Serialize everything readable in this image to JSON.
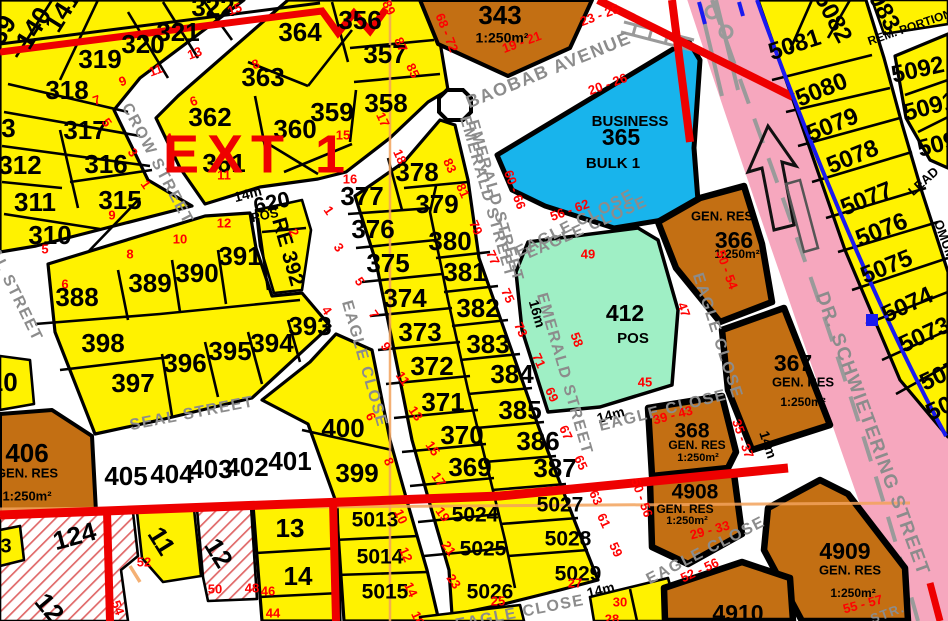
{
  "title": "EXT 1",
  "colors": {
    "yellow": "#FFF200",
    "orange": "#C36F13",
    "cyan": "#18B4EC",
    "green": "#9FEFC5",
    "pink": "#F6A7BE",
    "hatch": "#E06868",
    "redline": "#EE0000",
    "red_text": "#FF0000",
    "blue": "#1A1AEF",
    "street_gray": "#8C8C8C",
    "orangeline": "#F2A25C"
  },
  "labels": {
    "ext": [
      [
        "EXT 1",
        258,
        158
      ]
    ],
    "plots": [
      [
        "313",
        -6,
        130
      ],
      [
        "312",
        20,
        167
      ],
      [
        "311",
        35,
        204
      ],
      [
        "310",
        50,
        237
      ],
      [
        "318",
        67,
        92
      ],
      [
        "319",
        100,
        61
      ],
      [
        "317",
        85,
        132
      ],
      [
        "316",
        106,
        166
      ],
      [
        "315",
        120,
        202
      ],
      [
        "320",
        143,
        46
      ],
      [
        "321",
        178,
        34
      ],
      [
        "322",
        213,
        9
      ],
      [
        "139",
        0,
        37,
        -58
      ],
      [
        "140",
        35,
        29,
        -58
      ],
      [
        "141",
        64,
        12,
        -58
      ],
      [
        "364",
        300,
        34
      ],
      [
        "363",
        263,
        79
      ],
      [
        "362",
        210,
        119
      ],
      [
        "361",
        224,
        165
      ],
      [
        "360",
        295,
        131
      ],
      [
        "356",
        360,
        22
      ],
      [
        "357",
        385,
        56
      ],
      [
        "358",
        386,
        105
      ],
      [
        "359",
        332,
        114
      ],
      [
        "343",
        500,
        17
      ],
      [
        "377",
        362,
        198
      ],
      [
        "378",
        417,
        174
      ],
      [
        "379",
        437,
        206
      ],
      [
        "376",
        373,
        231
      ],
      [
        "375",
        388,
        265
      ],
      [
        "374",
        405,
        300
      ],
      [
        "373",
        420,
        334
      ],
      [
        "372",
        432,
        368
      ],
      [
        "371",
        443,
        404
      ],
      [
        "370",
        462,
        437
      ],
      [
        "369",
        470,
        469
      ],
      [
        "380",
        450,
        243
      ],
      [
        "381",
        465,
        274
      ],
      [
        "382",
        478,
        310
      ],
      [
        "383",
        488,
        346
      ],
      [
        "384",
        512,
        376
      ],
      [
        "385",
        520,
        412
      ],
      [
        "386",
        538,
        443
      ],
      [
        "387",
        555,
        470
      ],
      [
        "388",
        77,
        299
      ],
      [
        "389",
        150,
        285
      ],
      [
        "390",
        197,
        275
      ],
      [
        "391",
        240,
        258
      ],
      [
        "RE 392",
        287,
        252,
        74,
        21
      ],
      [
        "620",
        272,
        204,
        -12,
        22
      ],
      [
        "393",
        310,
        328
      ],
      [
        "394",
        272,
        345
      ],
      [
        "395",
        230,
        353
      ],
      [
        "396",
        185,
        365
      ],
      [
        "397",
        133,
        385
      ],
      [
        "398",
        103,
        345
      ],
      [
        "399",
        357,
        475
      ],
      [
        "400",
        343,
        430
      ],
      [
        "401",
        290,
        463
      ],
      [
        "402",
        247,
        469
      ],
      [
        "403",
        211,
        471
      ],
      [
        "404",
        172,
        476
      ],
      [
        "405",
        126,
        478
      ],
      [
        "406",
        27,
        455
      ],
      [
        "410",
        -4,
        384
      ],
      [
        "124",
        75,
        538,
        -15
      ],
      [
        "11",
        160,
        542,
        58
      ],
      [
        "12",
        217,
        554,
        58
      ],
      [
        "13",
        290,
        530
      ],
      [
        "14",
        298,
        578
      ],
      [
        "12",
        48,
        609,
        50
      ],
      [
        "3",
        6,
        547,
        0,
        20
      ],
      [
        "365",
        621,
        139,
        0,
        23
      ],
      [
        "412",
        625,
        315,
        0,
        23
      ],
      [
        "366",
        734,
        242,
        0,
        23
      ],
      [
        "367",
        793,
        365,
        0,
        23
      ],
      [
        "368",
        692,
        432,
        0,
        21
      ],
      [
        "4908",
        695,
        493,
        0,
        21
      ],
      [
        "4909",
        845,
        553,
        0,
        23
      ],
      [
        "4910",
        738,
        615,
        0,
        23
      ],
      [
        "5013",
        375,
        521,
        0,
        21
      ],
      [
        "5014",
        380,
        558,
        0,
        21
      ],
      [
        "5015",
        385,
        593,
        0,
        21
      ],
      [
        "5024",
        475,
        516,
        0,
        21
      ],
      [
        "5025",
        483,
        550,
        0,
        21
      ],
      [
        "5026",
        490,
        593,
        0,
        21
      ],
      [
        "5027",
        560,
        506,
        0,
        21
      ],
      [
        "5028",
        568,
        540,
        0,
        21
      ],
      [
        "5029",
        578,
        575,
        0,
        21
      ],
      [
        "5081",
        795,
        46,
        -18,
        24
      ],
      [
        "5080",
        822,
        91,
        -22,
        24
      ],
      [
        "5079",
        833,
        126,
        -22,
        24
      ],
      [
        "5078",
        853,
        158,
        -22,
        24
      ],
      [
        "5077",
        867,
        200,
        -22,
        24
      ],
      [
        "5076",
        882,
        231,
        -22,
        24
      ],
      [
        "5075",
        887,
        268,
        -22,
        24
      ],
      [
        "5074",
        908,
        306,
        -25,
        24
      ],
      [
        "5073",
        925,
        336,
        -25,
        24
      ],
      [
        "5072",
        946,
        374,
        -25,
        24
      ],
      [
        "5071",
        952,
        404,
        -25,
        24
      ],
      [
        "5082",
        832,
        18,
        62,
        24
      ],
      [
        "5083",
        880,
        6,
        62,
        24
      ],
      [
        "5092",
        918,
        71,
        -12,
        24
      ],
      [
        "5091",
        930,
        108,
        -15,
        24
      ],
      [
        "5090",
        944,
        144,
        -15,
        24
      ]
    ],
    "areas": [
      [
        "POS",
        265,
        216,
        -12,
        13
      ],
      [
        "POS",
        633,
        339,
        0,
        15
      ],
      [
        "BUSINESS",
        630,
        122,
        0,
        15
      ],
      [
        "BULK 1",
        613,
        164,
        0,
        15
      ],
      [
        "GEN. RES",
        27,
        474,
        0,
        13
      ],
      [
        "1:250m²",
        27,
        497,
        0,
        13
      ],
      [
        "1:250m²",
        502,
        39,
        0,
        14
      ],
      [
        "GEN. RES",
        722,
        217,
        0,
        13
      ],
      [
        "1:250m²",
        737,
        255,
        0,
        12
      ],
      [
        "GEN. RES",
        803,
        383,
        0,
        13
      ],
      [
        "1:250m²",
        803,
        403,
        0,
        12
      ],
      [
        "GEN. RES",
        697,
        446,
        0,
        12
      ],
      [
        "1:250m²",
        698,
        458,
        0,
        11
      ],
      [
        "GEN. RES",
        685,
        510,
        0,
        12
      ],
      [
        "1:250m²",
        687,
        521,
        0,
        11
      ],
      [
        "GEN. RES",
        850,
        571,
        0,
        13
      ],
      [
        "1:250m²",
        853,
        594,
        0,
        12
      ],
      [
        "REM. PORTION",
        910,
        28,
        -19,
        12
      ],
      [
        "LEAD",
        924,
        182,
        -42,
        13
      ],
      [
        "OMUMBONDE",
        952,
        262,
        70,
        13
      ],
      [
        "14m",
        248,
        195,
        -15,
        14
      ],
      [
        "14m",
        611,
        416,
        -16,
        14
      ],
      [
        "14m",
        601,
        591,
        -14,
        14
      ],
      [
        "14m",
        767,
        445,
        72,
        14
      ],
      [
        "16m",
        536,
        314,
        74,
        14
      ]
    ],
    "streets": [
      [
        "CROW STREET",
        157,
        164,
        62
      ],
      [
        "BAOBAB AVENUE",
        549,
        71,
        -22,
        18
      ],
      [
        "EMERALD STREET",
        487,
        197,
        74
      ],
      [
        "EMERALD STREET",
        495,
        201,
        74
      ],
      [
        "EMERALD STREET",
        564,
        374,
        74
      ],
      [
        "SEAL STREET",
        192,
        414,
        -11
      ],
      [
        "SEAL STREET",
        10,
        284,
        64
      ],
      [
        "EAGLE CLOSE",
        364,
        364,
        74
      ],
      [
        "EAGLE CLOSE",
        575,
        224,
        -27
      ],
      [
        "EAGLE CLOSE",
        587,
        228,
        -24
      ],
      [
        "EAGLE CLOSE",
        717,
        336,
        72
      ],
      [
        "EAGLE CLOSE",
        663,
        411,
        -14
      ],
      [
        "EAGLE CLOSE",
        520,
        613,
        -11
      ],
      [
        "EAGLE CLOSE",
        706,
        551,
        -27
      ],
      [
        "DR. SCHWIETERING STREET",
        872,
        434,
        70,
        19
      ],
      [
        "STR.",
        888,
        614,
        -20,
        13
      ]
    ],
    "reds": [
      [
        "15",
        235,
        10,
        -20
      ],
      [
        "13",
        195,
        54,
        -20
      ],
      [
        "11",
        156,
        71,
        -20
      ],
      [
        "9",
        123,
        82,
        -20
      ],
      [
        "7",
        97,
        101,
        -20
      ],
      [
        "8",
        256,
        65,
        -20
      ],
      [
        "6",
        194,
        102,
        -20
      ],
      [
        "4",
        170,
        139,
        -20
      ],
      [
        "5",
        106,
        123,
        55
      ],
      [
        "3",
        132,
        153,
        55
      ],
      [
        "1",
        145,
        185,
        55
      ],
      [
        "5",
        45,
        250
      ],
      [
        "9",
        112,
        216
      ],
      [
        "11",
        224,
        176
      ],
      [
        "6",
        65,
        285
      ],
      [
        "8",
        130,
        255
      ],
      [
        "10",
        180,
        240
      ],
      [
        "12",
        224,
        224
      ],
      [
        "2",
        293,
        233,
        65
      ],
      [
        "1",
        328,
        211,
        55
      ],
      [
        "89",
        388,
        8,
        65
      ],
      [
        "87",
        400,
        45,
        65
      ],
      [
        "85",
        412,
        71,
        65
      ],
      [
        "17",
        382,
        120,
        65
      ],
      [
        "15",
        343,
        136
      ],
      [
        "18",
        399,
        157,
        65
      ],
      [
        "16",
        350,
        180
      ],
      [
        "83",
        449,
        166,
        65
      ],
      [
        "81",
        462,
        191,
        65
      ],
      [
        "79",
        475,
        228,
        65
      ],
      [
        "77",
        492,
        258,
        65
      ],
      [
        "75",
        507,
        296,
        65
      ],
      [
        "73",
        520,
        330,
        65
      ],
      [
        "71",
        538,
        361,
        65
      ],
      [
        "69",
        551,
        395,
        65
      ],
      [
        "67",
        565,
        433,
        65
      ],
      [
        "65",
        580,
        463,
        65
      ],
      [
        "63",
        595,
        498,
        65
      ],
      [
        "61",
        603,
        521,
        65
      ],
      [
        "59",
        615,
        550,
        65
      ],
      [
        "68 - 72",
        446,
        33,
        68
      ],
      [
        "19 - 21",
        522,
        43,
        -20
      ],
      [
        "23 - 25",
        600,
        16,
        -20
      ],
      [
        "20 - 26",
        608,
        85,
        -20
      ],
      [
        "60 - 66",
        514,
        190,
        70
      ],
      [
        "56 - 62",
        570,
        211,
        -20
      ],
      [
        "49",
        588,
        255
      ],
      [
        "58",
        576,
        340,
        70
      ],
      [
        "47",
        683,
        310,
        70
      ],
      [
        "45",
        645,
        383
      ],
      [
        "50 - 54",
        726,
        270,
        70
      ],
      [
        "39 - 43",
        673,
        416,
        -15
      ],
      [
        "35 - 37",
        742,
        439,
        70
      ],
      [
        "29 - 33",
        710,
        531,
        -15
      ],
      [
        "50 - 56",
        641,
        498,
        70
      ],
      [
        "52 - 56",
        700,
        571,
        -25
      ],
      [
        "55 - 57",
        863,
        605,
        -15
      ],
      [
        "3",
        338,
        248,
        55
      ],
      [
        "5",
        359,
        282,
        55
      ],
      [
        "7",
        373,
        315,
        55
      ],
      [
        "9",
        385,
        347,
        55
      ],
      [
        "11",
        402,
        379,
        55
      ],
      [
        "13",
        415,
        414,
        55
      ],
      [
        "15",
        432,
        449,
        55
      ],
      [
        "17",
        438,
        480,
        55
      ],
      [
        "19",
        442,
        515,
        55
      ],
      [
        "21",
        448,
        549,
        55
      ],
      [
        "23",
        453,
        582,
        55
      ],
      [
        "25",
        498,
        602
      ],
      [
        "27",
        575,
        584
      ],
      [
        "4",
        326,
        311,
        55
      ],
      [
        "6",
        370,
        417,
        65
      ],
      [
        "8",
        388,
        462,
        65
      ],
      [
        "10",
        400,
        517,
        65
      ],
      [
        "12",
        405,
        555,
        65
      ],
      [
        "14",
        410,
        590,
        65
      ],
      [
        "16",
        417,
        619,
        65
      ],
      [
        "30",
        620,
        603
      ],
      [
        "28",
        612,
        620
      ],
      [
        "52",
        144,
        563
      ],
      [
        "50",
        215,
        590
      ],
      [
        "48",
        252,
        589
      ],
      [
        "46",
        268,
        592
      ],
      [
        "44",
        273,
        614
      ],
      [
        "54",
        117,
        608,
        70
      ]
    ]
  }
}
